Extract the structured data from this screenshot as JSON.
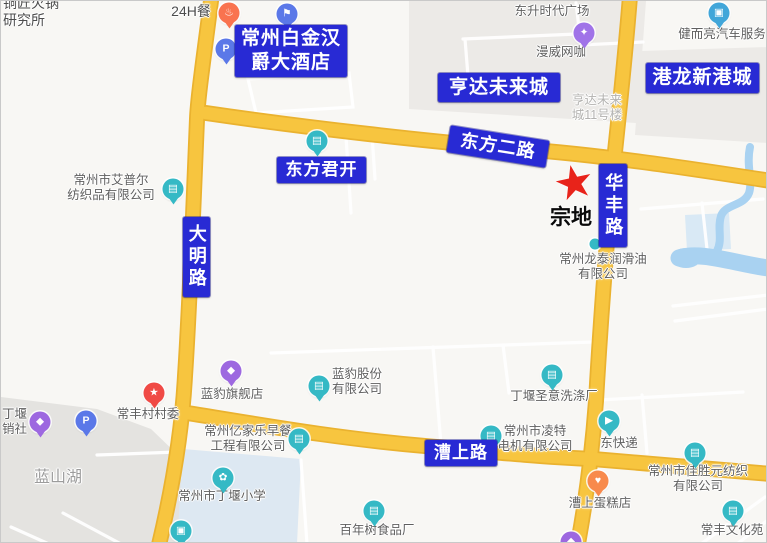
{
  "colors": {
    "background": "#f8f7f4",
    "road": "#f7c53f",
    "road_casing": "#eab22f",
    "river": "#a9d2f1",
    "label_box": "#282ad4",
    "parcel_star": "#e8231a",
    "teal_marker": "#35b9c5",
    "purple_marker": "#9d68e0",
    "blue_marker": "#5b78e8",
    "red_marker": "#f04a45",
    "orange_marker": "#f97c52"
  },
  "parcel": {
    "label": "宗地",
    "star_x": 573,
    "star_y": 181,
    "label_x": 549,
    "label_y": 200
  },
  "road_labels": [
    {
      "name": "label-hotel-baijinhanjue",
      "lines": [
        "常州白金汉",
        "爵大酒店"
      ],
      "x": 234,
      "y": 24,
      "w": 112,
      "h": 52,
      "font": 19
    },
    {
      "name": "label-hengda-weilaicheng",
      "lines": [
        "亨达未来城"
      ],
      "x": 437,
      "y": 72,
      "w": 122,
      "h": 29,
      "font": 19
    },
    {
      "name": "label-ganglong-xingangcheng",
      "lines": [
        "港龙新港城"
      ],
      "x": 645,
      "y": 62,
      "w": 113,
      "h": 30,
      "font": 19
    },
    {
      "name": "label-dongfang-er-road",
      "lines": [
        "东方二路"
      ],
      "x": 447,
      "y": 132,
      "w": 100,
      "h": 27,
      "font": 18,
      "rotate": 9
    },
    {
      "name": "label-dongfang-junkai",
      "lines": [
        "东方君开"
      ],
      "x": 276,
      "y": 156,
      "w": 89,
      "h": 26,
      "font": 17
    },
    {
      "name": "label-huafeng-road",
      "lines": [
        "华丰路"
      ],
      "x": 598,
      "y": 163,
      "w": 28,
      "h": 83,
      "font": 18,
      "vertical": true
    },
    {
      "name": "label-daming-road",
      "lines": [
        "大明路"
      ],
      "x": 182,
      "y": 216,
      "w": 27,
      "h": 80,
      "font": 18,
      "vertical": true
    },
    {
      "name": "label-caoshang-road",
      "lines": [
        "漕上路"
      ],
      "x": 424,
      "y": 439,
      "w": 72,
      "h": 26,
      "font": 17
    }
  ],
  "poi_labels": [
    {
      "name": "text-yanjiusuo",
      "lines": [
        "铜匠火锅",
        "研究所"
      ],
      "x": 2,
      "y": -6,
      "align": "left",
      "size": 14,
      "color": "#4d4d4d"
    },
    {
      "name": "text-24h-can",
      "lines": [
        "24H餐"
      ],
      "x": 190,
      "y": 2,
      "size": 14,
      "color": "#4d4d4d"
    },
    {
      "name": "text-dongsheng-plaza",
      "lines": [
        "东升时代广场"
      ],
      "x": 551,
      "y": 3
    },
    {
      "name": "text-manwei-wangka",
      "lines": [
        "漫威网咖"
      ],
      "x": 560,
      "y": 44
    },
    {
      "name": "text-jianerliang",
      "lines": [
        "健而亮汽车服务"
      ],
      "x": 721,
      "y": 26
    },
    {
      "name": "text-hengda-11haolou",
      "lines": [
        "亨达未来",
        "城11号楼"
      ],
      "x": 596,
      "y": 92,
      "color": "#b3b2b0"
    },
    {
      "name": "text-aipuer",
      "lines": [
        "常州市艾普尔",
        "纺织品有限公司"
      ],
      "x": 110,
      "y": 172
    },
    {
      "name": "text-longtai-runhuayou",
      "lines": [
        "常州龙泰润滑油",
        "有限公司"
      ],
      "x": 602,
      "y": 251
    },
    {
      "name": "text-lanbao-qijiandian",
      "lines": [
        "蓝豹旗舰店"
      ],
      "x": 231,
      "y": 386
    },
    {
      "name": "text-lanbao-gufen",
      "lines": [
        "蓝豹股份",
        "有限公司"
      ],
      "x": 356,
      "y": 366
    },
    {
      "name": "text-shengyi-xidichang",
      "lines": [
        "丁堰圣意洗涤厂"
      ],
      "x": 553,
      "y": 388
    },
    {
      "name": "text-changfeng-cunweihui",
      "lines": [
        "常丰村村委"
      ],
      "x": 147,
      "y": 406
    },
    {
      "name": "text-gongxiaoshe",
      "lines": [
        "丁堰",
        "销社"
      ],
      "x": 1,
      "y": 406,
      "align": "left"
    },
    {
      "name": "text-lanshanhu",
      "lines": [
        "蓝山湖"
      ],
      "x": 57,
      "y": 468,
      "size": 16,
      "color": "#9c9c9c"
    },
    {
      "name": "text-yijiale-zaocan",
      "lines": [
        "常州亿家乐早餐",
        "工程有限公司"
      ],
      "x": 247,
      "y": 423
    },
    {
      "name": "text-lingte-dianji",
      "lines": [
        "常州市凌特",
        "电机有限公司"
      ],
      "x": 534,
      "y": 423,
      "layer": "under"
    },
    {
      "name": "text-dongkuaidi",
      "lines": [
        "东快递"
      ],
      "x": 618,
      "y": 435
    },
    {
      "name": "text-dingyan-xiaoxue",
      "lines": [
        "常州市丁堰小学"
      ],
      "x": 221,
      "y": 488
    },
    {
      "name": "text-bainianshu",
      "lines": [
        "百年树食品厂"
      ],
      "x": 376,
      "y": 522
    },
    {
      "name": "text-jiasheng-fangzhi",
      "lines": [
        "常州市佳胜元纺织",
        "有限公司"
      ],
      "x": 697,
      "y": 463,
      "layer": "under"
    },
    {
      "name": "text-caoshang-dangaodian",
      "lines": [
        "漕上蛋糕店"
      ],
      "x": 599,
      "y": 495
    },
    {
      "name": "text-changfeng-wenhuayuan",
      "lines": [
        "常丰文化苑"
      ],
      "x": 731,
      "y": 522
    }
  ],
  "markers": [
    {
      "name": "food-marker-24h",
      "type": "restaurant-icon",
      "glyph": "♨",
      "color": "#f9734f",
      "x": 228,
      "y": 12
    },
    {
      "name": "hotel-marker",
      "type": "hotel-flag-icon",
      "glyph": "⚑",
      "color": "#5b78e8",
      "x": 286,
      "y": 13
    },
    {
      "name": "parking-marker-hotel",
      "type": "parking-icon",
      "glyph": "P",
      "color": "#5b78e8",
      "x": 225,
      "y": 48
    },
    {
      "name": "entertainment-marker-wangka",
      "type": "game-icon",
      "glyph": "✦",
      "color": "#a073e8",
      "x": 583,
      "y": 32
    },
    {
      "name": "car-service-marker",
      "type": "car-icon",
      "glyph": "▣",
      "color": "#41a6d9",
      "x": 718,
      "y": 12
    },
    {
      "name": "company-marker-dongfangjunkai",
      "type": "building-icon",
      "glyph": "▤",
      "color": "#35b9c5",
      "x": 316,
      "y": 140
    },
    {
      "name": "company-marker-aipuer",
      "type": "building-icon",
      "glyph": "▤",
      "color": "#35b9c5",
      "x": 172,
      "y": 188
    },
    {
      "name": "dot-marker-huafeng",
      "type": "dot-icon",
      "glyph": "",
      "color": "#35b9c5",
      "x": 594,
      "y": 243,
      "small": true
    },
    {
      "name": "company-marker-xidichang",
      "type": "building-icon",
      "glyph": "▤",
      "color": "#35b9c5",
      "x": 551,
      "y": 374
    },
    {
      "name": "shop-marker-lanbao",
      "type": "bag-icon",
      "glyph": "◆",
      "color": "#9d68e0",
      "x": 230,
      "y": 370
    },
    {
      "name": "company-marker-lanbaogufen",
      "type": "building-icon",
      "glyph": "▤",
      "color": "#35b9c5",
      "x": 318,
      "y": 385
    },
    {
      "name": "committee-marker-cunweihui",
      "type": "star-icon",
      "glyph": "★",
      "color": "#f04a45",
      "x": 153,
      "y": 392
    },
    {
      "name": "shop-marker-gongxiaoshe",
      "type": "bag-icon",
      "glyph": "◆",
      "color": "#9d68e0",
      "x": 39,
      "y": 421
    },
    {
      "name": "parking-marker-left",
      "type": "parking-icon",
      "glyph": "P",
      "color": "#5b78e8",
      "x": 85,
      "y": 420
    },
    {
      "name": "company-marker-yijiale",
      "type": "building-icon",
      "glyph": "▤",
      "color": "#35b9c5",
      "x": 298,
      "y": 438
    },
    {
      "name": "company-marker-lingte",
      "type": "building-icon",
      "glyph": "▤",
      "color": "#35b9c5",
      "x": 490,
      "y": 435
    },
    {
      "name": "courier-marker-dongkuaidi",
      "type": "truck-icon",
      "glyph": "▶",
      "color": "#35b9c5",
      "x": 608,
      "y": 420
    },
    {
      "name": "company-marker-jiasheng",
      "type": "building-icon",
      "glyph": "▤",
      "color": "#35b9c5",
      "x": 694,
      "y": 452
    },
    {
      "name": "cake-marker",
      "type": "cake-icon",
      "glyph": "♥",
      "color": "#f88a4c",
      "x": 597,
      "y": 480
    },
    {
      "name": "school-marker-dingyan",
      "type": "school-icon",
      "glyph": "✿",
      "color": "#35b9c5",
      "x": 222,
      "y": 477
    },
    {
      "name": "carwash-marker",
      "type": "car-icon",
      "glyph": "▣",
      "color": "#35b9c5",
      "x": 180,
      "y": 530
    },
    {
      "name": "company-marker-bainianshu",
      "type": "building-icon",
      "glyph": "▤",
      "color": "#35b9c5",
      "x": 373,
      "y": 510
    },
    {
      "name": "culture-marker-changfeng",
      "type": "building-icon",
      "glyph": "▤",
      "color": "#35b9c5",
      "x": 732,
      "y": 510
    },
    {
      "name": "shop-marker-bottom",
      "type": "bag-icon",
      "glyph": "◆",
      "color": "#9d68e0",
      "x": 570,
      "y": 541
    }
  ]
}
